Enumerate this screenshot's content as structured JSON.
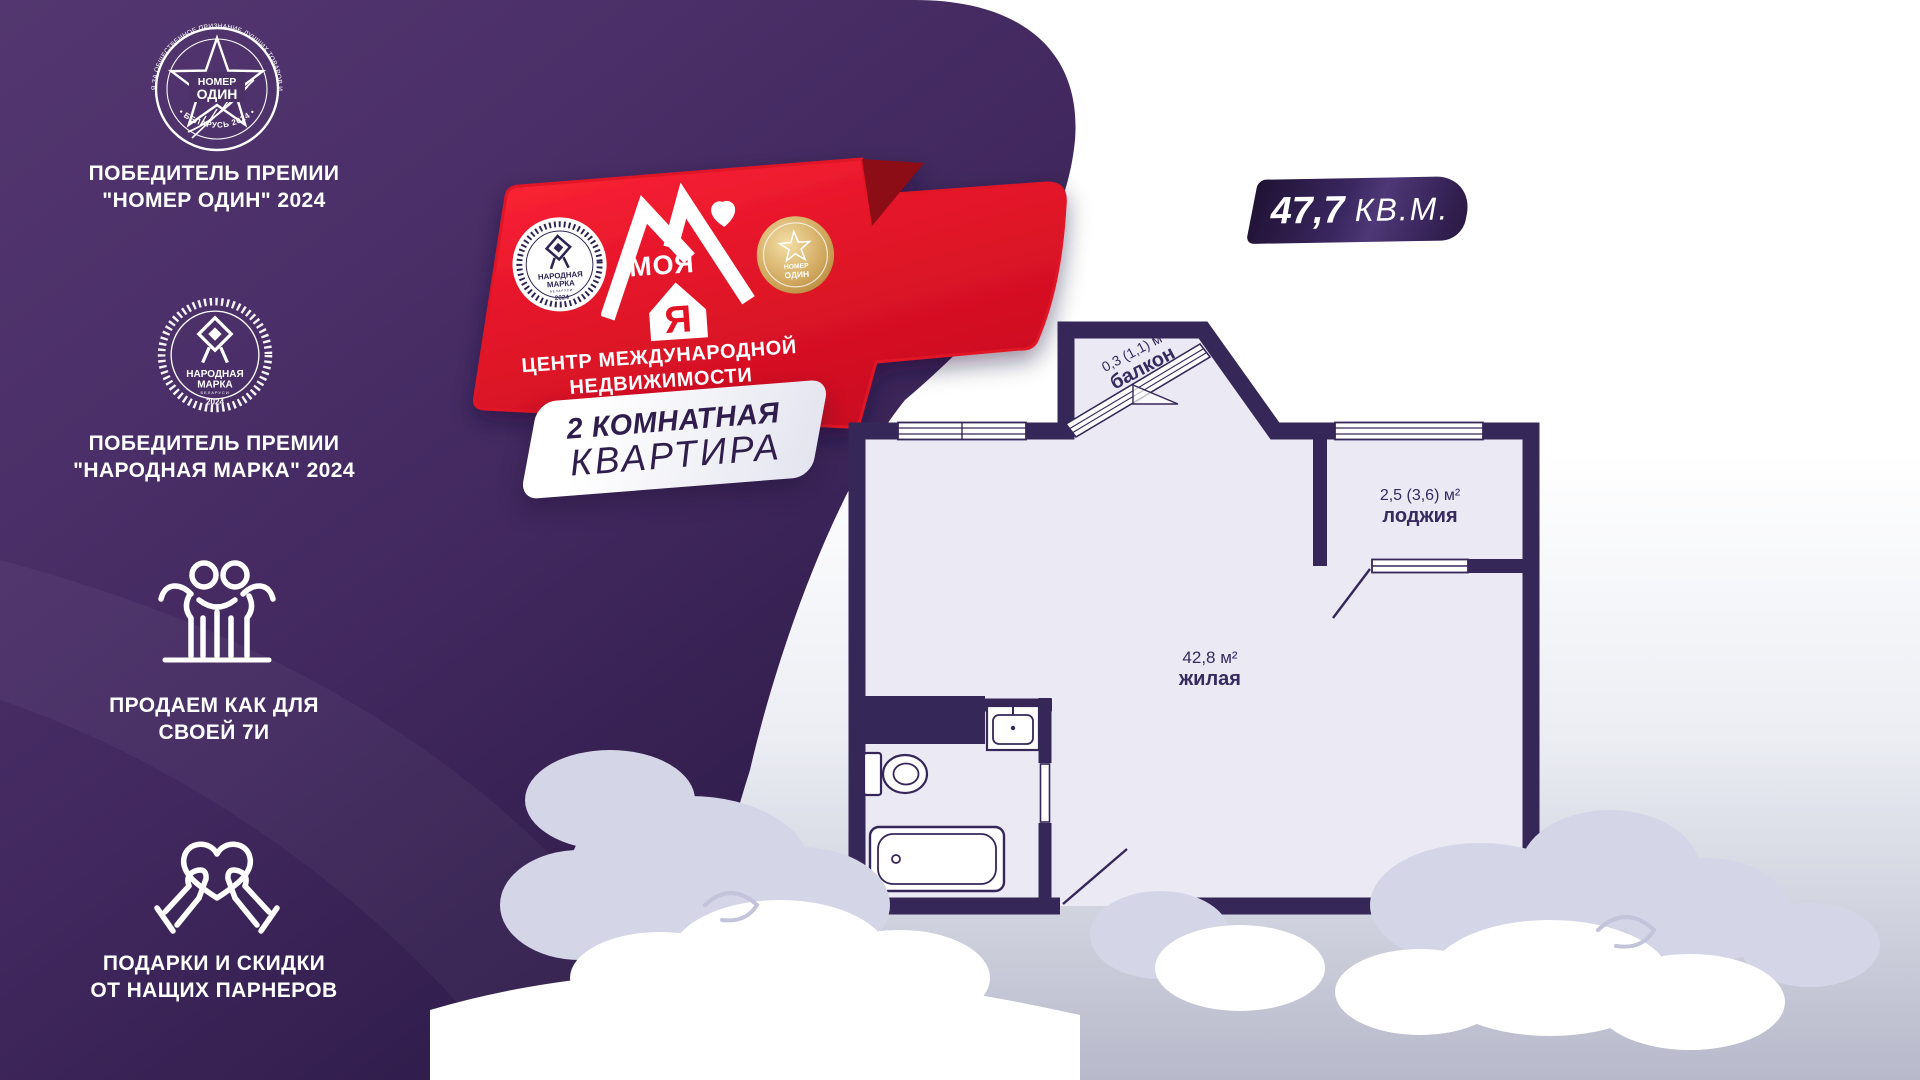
{
  "sidebar": {
    "award1": {
      "arc_top": "ПРЕМИЯ ЗА ОБЩЕСТВЕННОЕ ПРИЗНАНИЕ ЛУЧШИХ ТОВАРОВ И УСЛУГ",
      "name1": "НОМЕР",
      "name2": "ОДИН",
      "arc_bottom": "• БЕЛАРУСЬ 2024 •",
      "caption1": "ПОБЕДИТЕЛЬ ПРЕМИИ",
      "caption2": "\"НОМЕР ОДИН\" 2024"
    },
    "award2": {
      "name1": "НАРОДНАЯ",
      "name2": "МАРКА",
      "sub": "БЕЛАРУСИ",
      "year": "2024",
      "caption1": "ПОБЕДИТЕЛЬ ПРЕМИИ",
      "caption2": "\"НАРОДНАЯ МАРКА\" 2024"
    },
    "family": {
      "caption1": "ПРОДАЕМ КАК ДЛЯ",
      "caption2": "СВОЕЙ 7И"
    },
    "gifts": {
      "caption1": "ПОДАРКИ И СКИДКИ",
      "caption2": "ОТ НАЩИХ ПАРНЕРОВ"
    }
  },
  "brand": {
    "word": "МОЯ",
    "letter": "Я",
    "tagline1": "ЦЕНТР МЕЖДУНАРОДНОЙ",
    "tagline2": "НЕДВИЖИМОСТИ",
    "gold1": "НОМЕР",
    "gold2": "ОДИН"
  },
  "offer": {
    "type1": "2 КОМНАТНАЯ",
    "type2": "КВАРТИРА",
    "area": "47,7",
    "unit": "КВ.М."
  },
  "plan": {
    "balcony_area": "0,3 (1,1) м²",
    "balcony": "балкон",
    "loggia_area": "2,5 (3,6) м²",
    "loggia": "лоджия",
    "living_area": "42,8 м²",
    "living": "жилая",
    "bath_area": "4,9 м²"
  },
  "colors": {
    "purple_dark": "#342050",
    "purple_mid": "#4a2f66",
    "red": "#e5152a",
    "wall": "#362759",
    "room_fill": "#eae9f4",
    "cloud_lavender": "#d5d5e8",
    "gold": "#c9a158"
  }
}
